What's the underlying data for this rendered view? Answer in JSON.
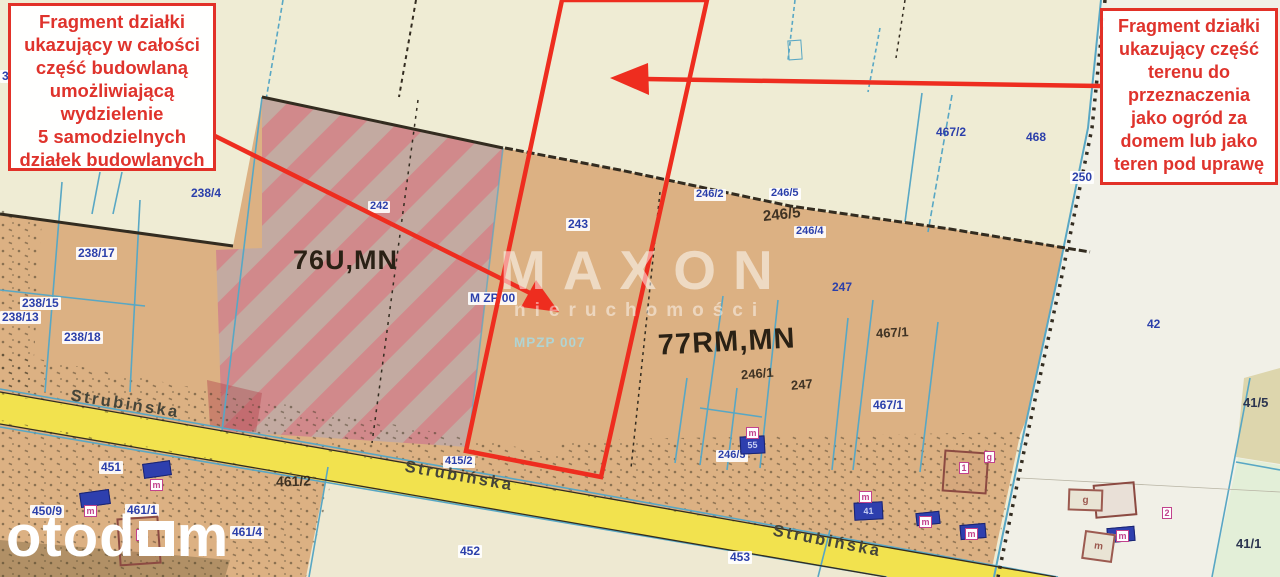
{
  "annotations": {
    "left_box": "Fragment działki\nukazujący w całości\nczęść budowlaną\numożliwiającą\nwydzielenie\n5 samodzielnych\ndziałek budowlanych",
    "right_box": "Fragment działki\nukazujący część\nterenu do\nprzeznaczenia\njako ogród za\ndomem lub jako\nteren pod uprawę"
  },
  "watermarks": {
    "brand": "MAXON",
    "brand_sub": "nieruchomości",
    "portal_prefix": "otod",
    "portal_suffix": "m"
  },
  "map": {
    "street_name": "Strubińska",
    "colors": {
      "accent_red": "#ee2d1f",
      "annotation_red": "#df332c",
      "parcel_tan": "#dcb183",
      "parcel_cream": "#efecd4",
      "parcel_light": "#f1f0e7",
      "hatch_pink": "#d0858c",
      "hatch_gray": "#c1a9a4",
      "road_yellow": "#f2e24e",
      "boundary_cyan": "#58a7c4",
      "boundary_dark": "#332c20",
      "label_blue": "#2b3faa",
      "building_blue": "#2e3fae",
      "chip_magenta": "#c2428c",
      "parcel_green": "#e3efd8",
      "parcel_olive": "#ddd6ad"
    },
    "labels": [
      {
        "text": "3",
        "x": 0,
        "y": 70,
        "type": "chip"
      },
      {
        "text": "238/4",
        "x": 191,
        "y": 187,
        "type": "blue"
      },
      {
        "text": "238/17",
        "x": 76,
        "y": 247,
        "type": "chip"
      },
      {
        "text": "238/15",
        "x": 20,
        "y": 297,
        "type": "chip"
      },
      {
        "text": "238/13",
        "x": 0,
        "y": 311,
        "type": "chip"
      },
      {
        "text": "238/18",
        "x": 62,
        "y": 331,
        "type": "chip"
      },
      {
        "text": "242",
        "x": 368,
        "y": 201,
        "type": "chip",
        "size": 11
      },
      {
        "text": "243",
        "x": 566,
        "y": 218,
        "type": "chip"
      },
      {
        "text": "246/2",
        "x": 694,
        "y": 189,
        "type": "chip",
        "size": 11
      },
      {
        "text": "246/5",
        "x": 769,
        "y": 188,
        "type": "chip",
        "size": 11
      },
      {
        "text": "246/5",
        "x": 763,
        "y": 207,
        "type": "dark-hand",
        "rot": -6,
        "size": 15
      },
      {
        "text": "246/4",
        "x": 794,
        "y": 226,
        "type": "chip",
        "size": 11
      },
      {
        "text": "247",
        "x": 832,
        "y": 281,
        "type": "blue"
      },
      {
        "text": "467/1",
        "x": 876,
        "y": 326,
        "type": "dark-hand",
        "rot": -3
      },
      {
        "text": "467/1",
        "x": 871,
        "y": 399,
        "type": "chip"
      },
      {
        "text": "246/1",
        "x": 741,
        "y": 367,
        "type": "dark-hand",
        "rot": -5
      },
      {
        "text": "247",
        "x": 791,
        "y": 378,
        "type": "dark-hand",
        "rot": -5
      },
      {
        "text": "467/2",
        "x": 936,
        "y": 126,
        "type": "blue"
      },
      {
        "text": "468",
        "x": 1026,
        "y": 131,
        "type": "blue"
      },
      {
        "text": "250",
        "x": 1070,
        "y": 171,
        "type": "chip"
      },
      {
        "text": "42",
        "x": 1147,
        "y": 318,
        "type": "blue"
      },
      {
        "text": "41/5",
        "x": 1243,
        "y": 396,
        "type": "dark-navy"
      },
      {
        "text": "41/1",
        "x": 1236,
        "y": 537,
        "type": "dark-navy"
      },
      {
        "text": "246/3",
        "x": 716,
        "y": 450,
        "type": "chip",
        "size": 11
      },
      {
        "text": "453",
        "x": 728,
        "y": 551,
        "type": "chip"
      },
      {
        "text": "452",
        "x": 458,
        "y": 545,
        "type": "chip"
      },
      {
        "text": "415/2",
        "x": 443,
        "y": 456,
        "type": "chip",
        "size": 11
      },
      {
        "text": "461/2",
        "x": 276,
        "y": 474,
        "type": "dark-hand",
        "size": 14,
        "rot": -2
      },
      {
        "text": "451",
        "x": 99,
        "y": 461,
        "type": "chip"
      },
      {
        "text": "450/9",
        "x": 30,
        "y": 505,
        "type": "chip"
      },
      {
        "text": "461/1",
        "x": 125,
        "y": 504,
        "type": "chip"
      },
      {
        "text": "461/4",
        "x": 230,
        "y": 526,
        "type": "chip"
      },
      {
        "text": "76U,MN",
        "x": 293,
        "y": 246,
        "type": "zone",
        "size": 27
      },
      {
        "text": "77RM,MN",
        "x": 658,
        "y": 327,
        "type": "zone",
        "size": 29,
        "rot": -3
      },
      {
        "text": "M ZP 00",
        "x": 468,
        "y": 292,
        "type": "chip",
        "size": 12
      },
      {
        "text": "MPZP 007",
        "x": 514,
        "y": 336,
        "type": "teal"
      },
      {
        "text": "Strubińska",
        "x": 70,
        "y": 396,
        "type": "street",
        "rot": 9
      },
      {
        "text": "Strubińska",
        "x": 404,
        "y": 468,
        "type": "street",
        "rot": 10
      },
      {
        "text": "Strubińska",
        "x": 772,
        "y": 533,
        "type": "street",
        "rot": 11
      }
    ],
    "buildings": [
      {
        "x": 80,
        "y": 491,
        "w": 30,
        "h": 15,
        "rot": -8,
        "style": "blue",
        "text": ""
      },
      {
        "x": 143,
        "y": 462,
        "w": 28,
        "h": 15,
        "rot": -8,
        "style": "blue",
        "text": ""
      },
      {
        "x": 740,
        "y": 436,
        "w": 25,
        "h": 18,
        "rot": -3,
        "style": "blue",
        "text": "55"
      },
      {
        "x": 854,
        "y": 502,
        "w": 29,
        "h": 18,
        "rot": -3,
        "style": "blue",
        "text": "41"
      },
      {
        "x": 916,
        "y": 512,
        "w": 24,
        "h": 13,
        "rot": -6,
        "style": "blue",
        "text": ""
      },
      {
        "x": 960,
        "y": 524,
        "w": 26,
        "h": 15,
        "rot": -5,
        "style": "blue",
        "text": ""
      },
      {
        "x": 1107,
        "y": 527,
        "w": 28,
        "h": 15,
        "rot": -5,
        "style": "blue",
        "text": ""
      },
      {
        "x": 943,
        "y": 451,
        "w": 45,
        "h": 42,
        "rot": 4,
        "style": "outline",
        "text": ""
      },
      {
        "x": 1094,
        "y": 483,
        "w": 42,
        "h": 34,
        "rot": -5,
        "style": "outline",
        "text": ""
      },
      {
        "x": 118,
        "y": 517,
        "w": 42,
        "h": 48,
        "rot": -4,
        "style": "outline",
        "text": ""
      },
      {
        "x": 1068,
        "y": 489,
        "w": 35,
        "h": 22,
        "rot": 2,
        "style": "light",
        "text": "g"
      },
      {
        "x": 1083,
        "y": 532,
        "w": 31,
        "h": 29,
        "rot": 8,
        "style": "light",
        "text": "m"
      },
      {
        "x": 788,
        "y": 40,
        "w": 14,
        "h": 20,
        "rot": -4,
        "style": "cyan",
        "text": ""
      }
    ],
    "building_chips": [
      {
        "x": 84,
        "y": 505,
        "text": "m"
      },
      {
        "x": 150,
        "y": 479,
        "text": "m"
      },
      {
        "x": 746,
        "y": 427,
        "text": "m"
      },
      {
        "x": 859,
        "y": 491,
        "text": "m"
      },
      {
        "x": 919,
        "y": 516,
        "text": "m"
      },
      {
        "x": 965,
        "y": 528,
        "text": "m"
      },
      {
        "x": 1116,
        "y": 530,
        "text": "m"
      },
      {
        "x": 959,
        "y": 462,
        "text": "1"
      },
      {
        "x": 984,
        "y": 451,
        "text": "g"
      },
      {
        "x": 1162,
        "y": 507,
        "text": "2"
      },
      {
        "x": 136,
        "y": 529,
        "text": "g"
      }
    ]
  }
}
